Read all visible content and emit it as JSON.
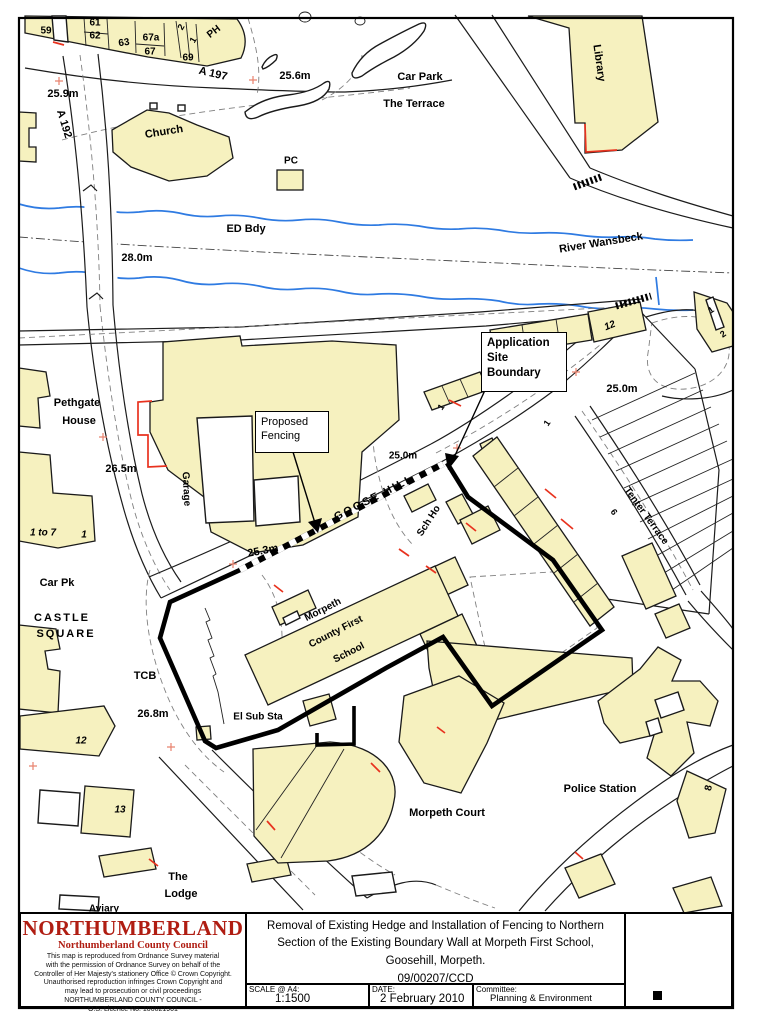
{
  "colors": {
    "building": "#f6f1bf",
    "river": "#2f7be2",
    "accent_red": "#e8321e",
    "cross": "#e8836f",
    "brand_red": "#b01d12"
  },
  "map": {
    "labels": [
      {
        "t": "59",
        "x": 46,
        "y": 31,
        "s": 10
      },
      {
        "t": "61",
        "x": 95,
        "y": 23,
        "s": 10
      },
      {
        "t": "62",
        "x": 95,
        "y": 36,
        "s": 10
      },
      {
        "t": "63",
        "x": 124,
        "y": 43,
        "s": 10,
        "r": -8
      },
      {
        "t": "67a",
        "x": 151,
        "y": 38,
        "s": 10
      },
      {
        "t": "67",
        "x": 150,
        "y": 52,
        "s": 10
      },
      {
        "t": "69",
        "x": 188,
        "y": 58,
        "s": 10
      },
      {
        "t": "2",
        "x": 181,
        "y": 27,
        "s": 9,
        "r": -60
      },
      {
        "t": "1",
        "x": 193,
        "y": 40,
        "s": 9,
        "r": -60
      },
      {
        "t": "PH",
        "x": 214,
        "y": 32,
        "s": 10,
        "r": -38
      },
      {
        "t": "A 197",
        "x": 213,
        "y": 74,
        "s": 11,
        "r": 13
      },
      {
        "t": "25.6m",
        "x": 295,
        "y": 76,
        "s": 11
      },
      {
        "t": "25.9m",
        "x": 63,
        "y": 94,
        "s": 11
      },
      {
        "t": "Car Park",
        "x": 420,
        "y": 77,
        "s": 11
      },
      {
        "t": "The Terrace",
        "x": 414,
        "y": 104,
        "s": 11
      },
      {
        "t": "Library",
        "x": 599,
        "y": 63,
        "s": 11,
        "r": 82
      },
      {
        "t": "A 192",
        "x": 64,
        "y": 124,
        "s": 11,
        "r": 73
      },
      {
        "t": "Church",
        "x": 164,
        "y": 132,
        "s": 11,
        "r": -9
      },
      {
        "t": "PC",
        "x": 291,
        "y": 161,
        "s": 10
      },
      {
        "t": "ED Bdy",
        "x": 246,
        "y": 229,
        "s": 11
      },
      {
        "t": "28.0m",
        "x": 137,
        "y": 258,
        "s": 11
      },
      {
        "t": "River Wansbeck",
        "x": 601,
        "y": 243,
        "s": 11,
        "r": -9
      },
      {
        "t": "12",
        "x": 610,
        "y": 326,
        "s": 10,
        "r": -22,
        "i": true
      },
      {
        "t": "1",
        "x": 711,
        "y": 310,
        "s": 9,
        "r": -35
      },
      {
        "t": "2",
        "x": 723,
        "y": 334,
        "s": 9,
        "r": -35
      },
      {
        "t": "25.0m",
        "x": 622,
        "y": 389,
        "s": 11
      },
      {
        "t": "Pethgate",
        "x": 77,
        "y": 403,
        "s": 11
      },
      {
        "t": "House",
        "x": 79,
        "y": 421,
        "s": 11
      },
      {
        "t": "26.5m",
        "x": 121,
        "y": 469,
        "s": 11
      },
      {
        "t": "Garage",
        "x": 186,
        "y": 489,
        "s": 10,
        "r": 87
      },
      {
        "t": "1",
        "x": 441,
        "y": 407,
        "s": 9,
        "r": -55
      },
      {
        "t": "1",
        "x": 547,
        "y": 423,
        "s": 9,
        "r": -55
      },
      {
        "t": "25.0m",
        "x": 403,
        "y": 456,
        "s": 10
      },
      {
        "t": "GOOSE HILL",
        "x": 374,
        "y": 498,
        "s": 11,
        "r": -27,
        "ls": 2
      },
      {
        "t": "25.3m",
        "x": 263,
        "y": 551,
        "s": 11,
        "r": -11
      },
      {
        "t": "Sch Ho",
        "x": 429,
        "y": 521,
        "s": 10,
        "r": -57
      },
      {
        "t": "Tenter Terrace",
        "x": 646,
        "y": 516,
        "s": 10,
        "r": 54
      },
      {
        "t": "6",
        "x": 614,
        "y": 512,
        "s": 9,
        "r": 54
      },
      {
        "t": "1 to 7",
        "x": 43,
        "y": 533,
        "s": 10,
        "i": true
      },
      {
        "t": "1",
        "x": 84,
        "y": 535,
        "s": 10,
        "i": true
      },
      {
        "t": "Car Pk",
        "x": 57,
        "y": 583,
        "s": 11
      },
      {
        "t": "CASTLE",
        "x": 62,
        "y": 618,
        "s": 11,
        "ls": 2
      },
      {
        "t": "SQUARE",
        "x": 66,
        "y": 634,
        "s": 11,
        "ls": 2
      },
      {
        "t": "TCB",
        "x": 145,
        "y": 676,
        "s": 11
      },
      {
        "t": "26.8m",
        "x": 153,
        "y": 714,
        "s": 11
      },
      {
        "t": "El Sub Sta",
        "x": 258,
        "y": 717,
        "s": 10
      },
      {
        "t": "Morpeth",
        "x": 323,
        "y": 610,
        "s": 10,
        "r": -27
      },
      {
        "t": "County First",
        "x": 336,
        "y": 632,
        "s": 10,
        "r": -27
      },
      {
        "t": "School",
        "x": 349,
        "y": 653,
        "s": 10,
        "r": -27
      },
      {
        "t": "12",
        "x": 81,
        "y": 741,
        "s": 10,
        "i": true
      },
      {
        "t": "13",
        "x": 120,
        "y": 810,
        "s": 10,
        "i": true
      },
      {
        "t": "Morpeth Court",
        "x": 447,
        "y": 813,
        "s": 11
      },
      {
        "t": "Police Station",
        "x": 600,
        "y": 789,
        "s": 11
      },
      {
        "t": "8",
        "x": 709,
        "y": 788,
        "s": 10,
        "r": -78
      },
      {
        "t": "The",
        "x": 178,
        "y": 877,
        "s": 11
      },
      {
        "t": "Lodge",
        "x": 181,
        "y": 894,
        "s": 11
      },
      {
        "t": "Aviary",
        "x": 104,
        "y": 909,
        "s": 10
      }
    ],
    "callouts": {
      "application": {
        "line1": "Application",
        "line2": "Site",
        "line3": "Boundary"
      },
      "fencing": {
        "line1": "Proposed",
        "line2": "Fencing"
      }
    }
  },
  "title_block": {
    "title_line1": "Removal of Existing Hedge and Installation of Fencing to Northern",
    "title_line2": "Section of the Existing Boundary Wall at Morpeth First School,",
    "title_line3": "Goosehill, Morpeth.",
    "ref": "09/00207/CCD",
    "scale_label": "SCALE @ A4:",
    "scale_value": "1:1500",
    "date_label": "DATE:",
    "date_value": "2 February 2010",
    "committee_label": "Committee:",
    "committee_value": "Planning & Environment"
  },
  "logo": {
    "name": "NORTHUMBERLAND",
    "subtitle": "Northumberland County Council",
    "copyright_lines": [
      "This map is reproduced from Ordnance Survey material",
      "with the permission of Ordnance Survey on behalf of the",
      "Controller of Her Majesty's stationery Office © Crown Copyright.",
      "Unauthorised  reproduction infringes Crown Copyright and",
      "may lead to prosecution or civil proceedings",
      "NORTHUMBERLAND COUNTY COUNCIL -",
      "O.S. Licence No. 100021901"
    ]
  }
}
